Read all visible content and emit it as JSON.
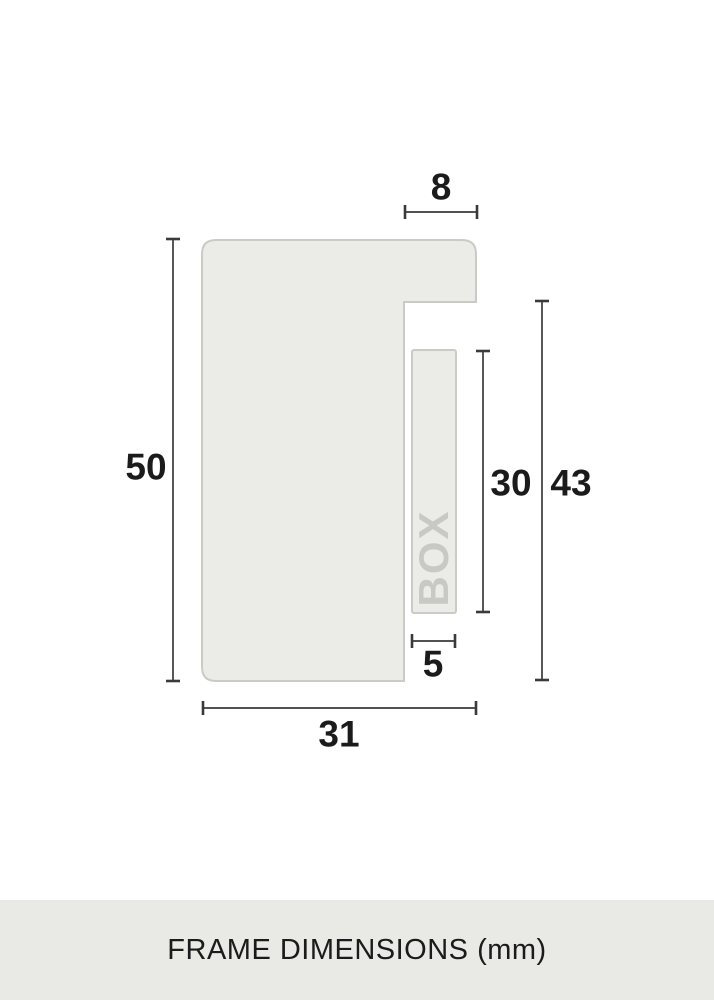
{
  "diagram": {
    "dimension_labels": {
      "lip_width": "8",
      "total_height": "50",
      "spacer_height": "30",
      "inner_height": "43",
      "spacer_width": "5",
      "total_width": "31"
    },
    "watermark": "BOX"
  },
  "footer": {
    "caption": "FRAME DIMENSIONS (mm)"
  },
  "colors": {
    "background": "#ffffff",
    "shape_fill": "#ebebe8",
    "shape_border": "#cbcbc6",
    "dimension_line": "#3a3a3a",
    "label_text": "#1b1b1b",
    "watermark_text": "#c9c9c4",
    "footer_bg": "#e9e9e6"
  }
}
